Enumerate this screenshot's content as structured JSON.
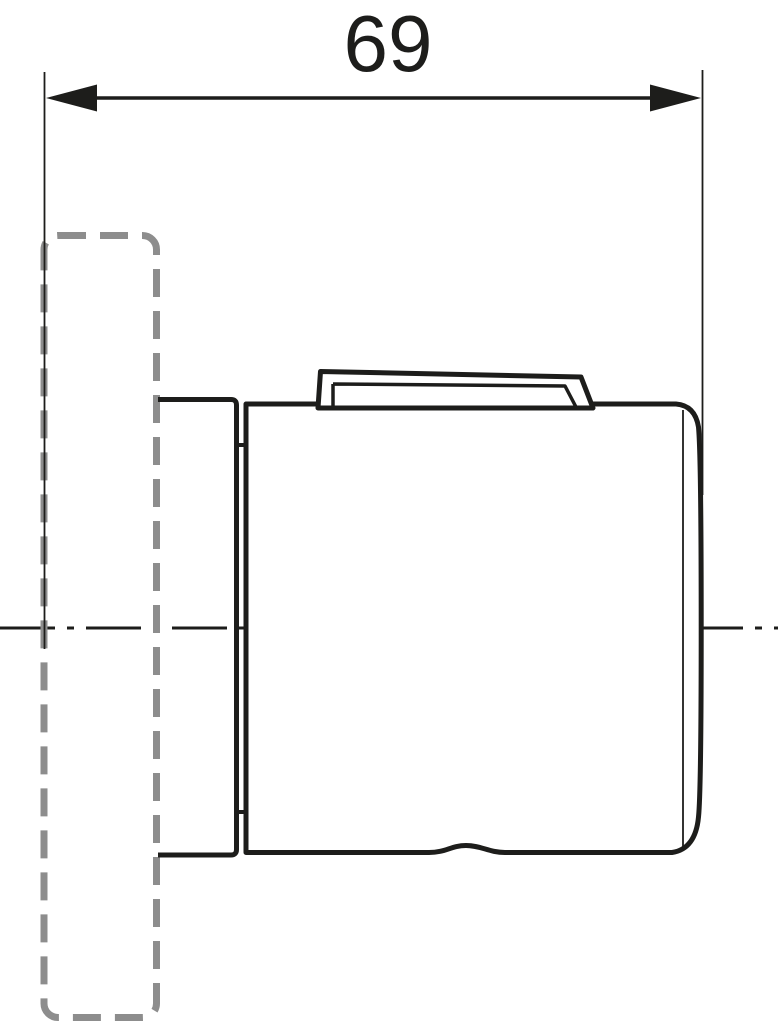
{
  "drawing": {
    "kind": "technical line drawing, side view of wall-mounted unit with concealed part",
    "dimension": {
      "value": "69"
    },
    "colors": {
      "line": "#1d1d1b",
      "hidden": "#8d8d8d",
      "background": "#ffffff"
    }
  }
}
